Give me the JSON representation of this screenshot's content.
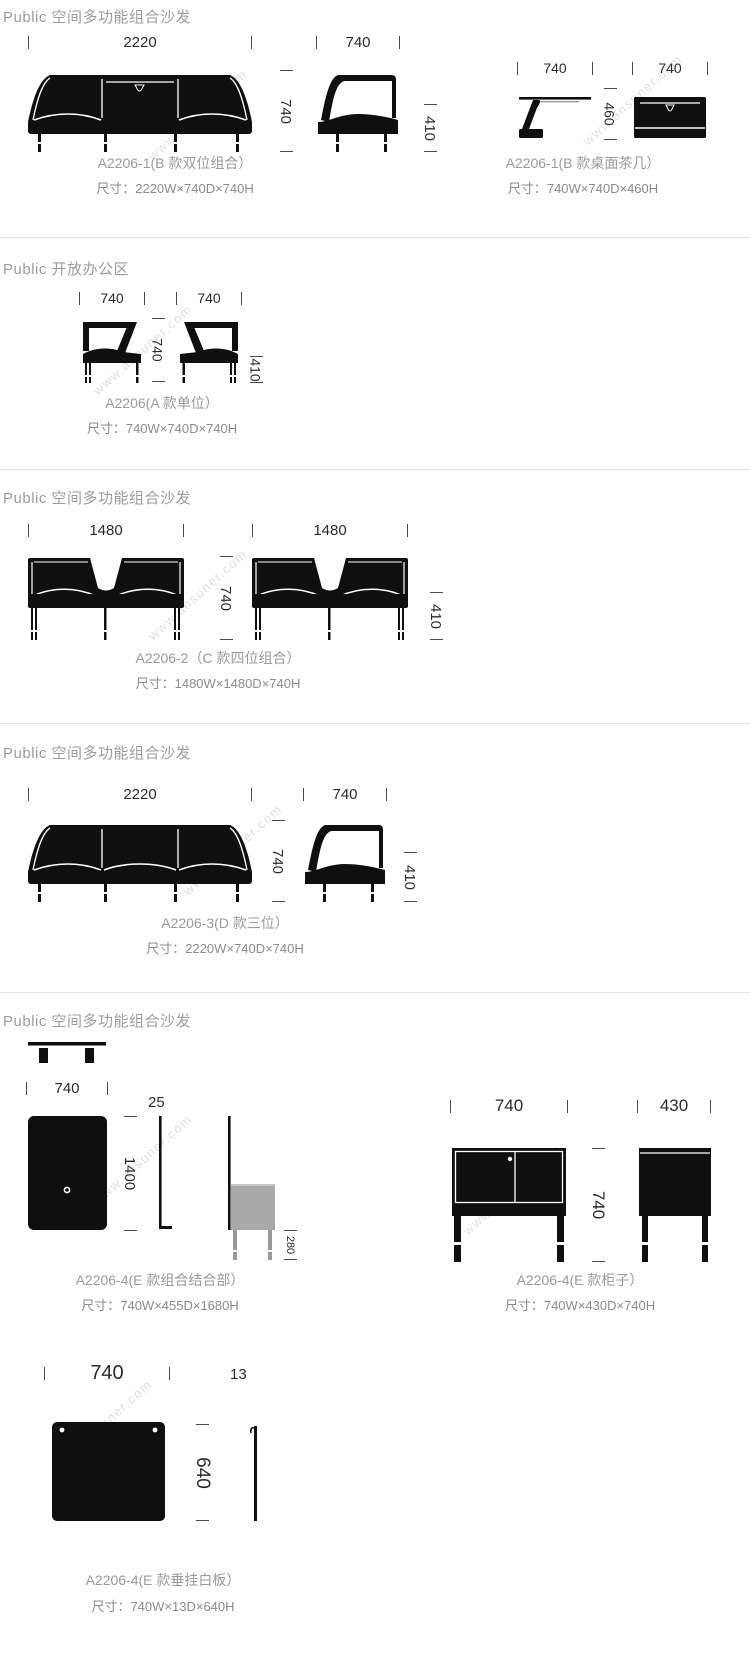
{
  "watermark": "www.ansuner.com",
  "s1": {
    "header": "Public 空间多功能组合沙发",
    "sofa": {
      "w": "2220",
      "h": "740",
      "side_w": "740",
      "side_h": "410",
      "label": "A2206-1(B 款双位组合）",
      "size": "尺寸：2220W×740D×740H"
    },
    "table": {
      "side_w": "740",
      "h": "460",
      "front_w": "740",
      "label": "A2206-1(B 款桌面茶几）",
      "size": "尺寸：740W×740D×460H"
    }
  },
  "s2": {
    "header": "Public 开放办公区",
    "unit": {
      "w1": "740",
      "w2": "740",
      "mid_h": "740",
      "seat_h": "410",
      "label": "A2206(A 款单位）",
      "size": "尺寸：740W×740D×740H"
    }
  },
  "s3": {
    "header": "Public 空间多功能组合沙发",
    "combo": {
      "w1": "1480",
      "w2": "1480",
      "mid_h": "740",
      "seat_h": "410",
      "label": "A2206-2（C 款四位组合）",
      "size": "尺寸：1480W×1480D×740H"
    }
  },
  "s4": {
    "header": "Public 空间多功能组合沙发",
    "sofa": {
      "w": "2220",
      "h": "740",
      "side_w": "740",
      "side_h": "410",
      "label": "A2206-3(D 款三位）",
      "size": "尺寸：2220W×740D×740H"
    }
  },
  "s5": {
    "header": "Public 空间多功能组合沙发",
    "combo": {
      "w": "740",
      "h": "1400",
      "panel_t": "25",
      "leg_h": "280",
      "label": "A2206-4(E 款组合结合部）",
      "size": "尺寸：740W×455D×1680H"
    },
    "cabinet": {
      "w": "740",
      "h": "740",
      "d": "430",
      "label": "A2206-4(E 款柜子）",
      "size": "尺寸：740W×430D×740H"
    },
    "board": {
      "w": "740",
      "t": "13",
      "h": "640",
      "label": "A2206-4(E 款垂挂白板）",
      "size": "尺寸：740W×13D×640H"
    }
  }
}
